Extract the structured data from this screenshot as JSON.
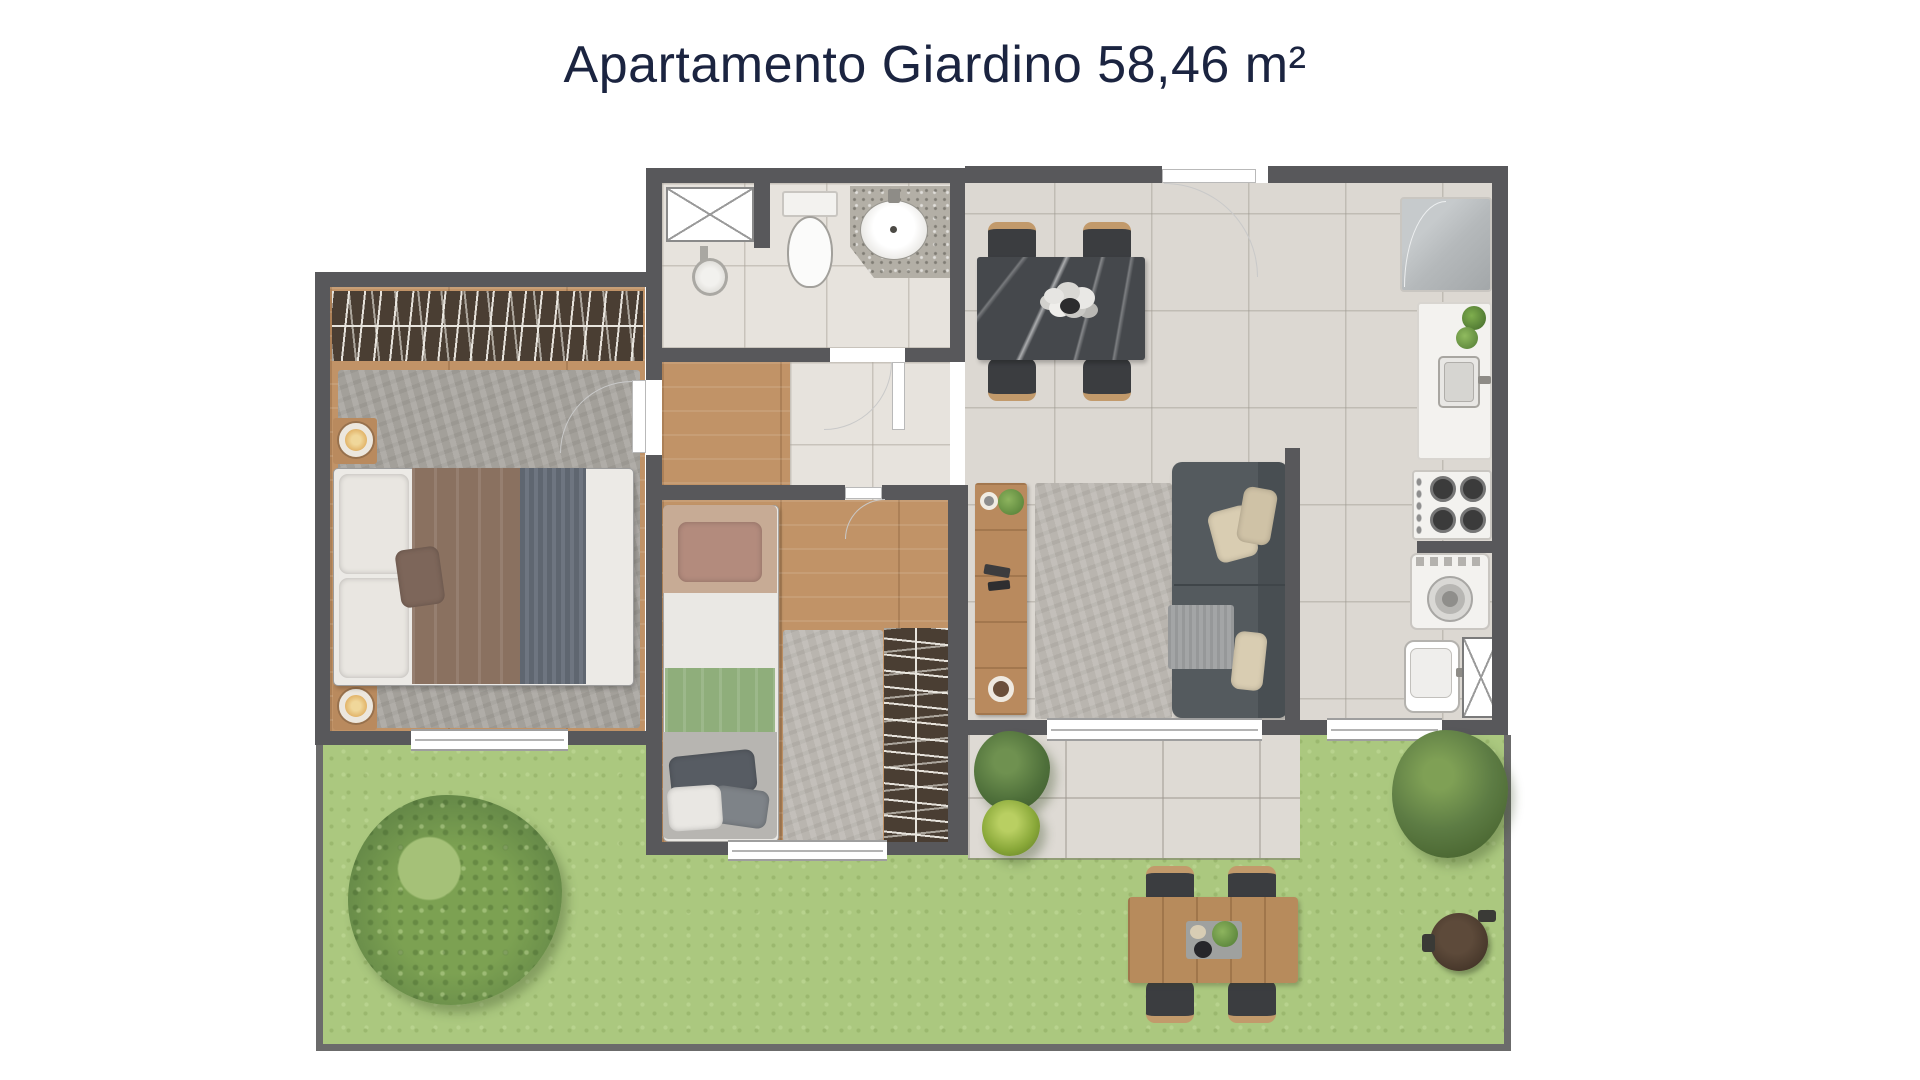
{
  "title": {
    "text": "Apartamento Giardino 58,46 m²"
  },
  "unit": {
    "type": "Apartamento Giardino",
    "area_m2": "58,46"
  },
  "palette": {
    "title": "#1b2440",
    "wall": "#58585b",
    "wall_thin": "#6b6b6b",
    "floor_tile": "#dcd8d2",
    "bath_tile": "#e7e3dd",
    "wood": "#c19367",
    "wardrobe": "#4a3e33",
    "rug_gray": "#a3a09a",
    "rug_light": "#b9b5af",
    "grass": "#abc87f",
    "tree": "#7ca152",
    "bush_dark": "#5d7c44",
    "patio": "#dedad4",
    "marble": "#45484c",
    "chair_dark": "#3b3d40",
    "chair_wood": "#c29a6b",
    "sofa": "#545a5e",
    "sofa_back": "#484e52",
    "pillow_beige": "#d9cdb2",
    "blanket_gray": "#a3a5a6",
    "bed_brown": "#8a7160",
    "bed_stripe": "#5f6670",
    "headboard_tan": "#c7ab95",
    "pillow_rose": "#b38b7d",
    "blanket_green": "#8fae7b",
    "granite": "#b3afa6",
    "appliance": "#f3f2ef",
    "fridge": "#b5b9bb",
    "lamp": "#e2b469",
    "plant_green": "#5f8a3d",
    "garden_table_wood": "#b78b5c",
    "round_table_brown": "#49392c"
  },
  "furniture": [
    "double-bed",
    "wardrobe-main",
    "nightstand-lamps",
    "shower-box",
    "toilet",
    "bathroom-sink-counter",
    "dining-table",
    "dining-chairs",
    "sofa",
    "living-rug",
    "tv-sideboard",
    "fridge",
    "kitchen-sink-counter",
    "stove",
    "washing-machine",
    "laundry-tub",
    "utility-shaft",
    "single-bed",
    "wardrobe-second",
    "second-bedroom-rug",
    "garden-tree",
    "garden-bush",
    "patio",
    "garden-dining-table",
    "garden-chairs",
    "fire-pit-table",
    "potted-plant"
  ]
}
